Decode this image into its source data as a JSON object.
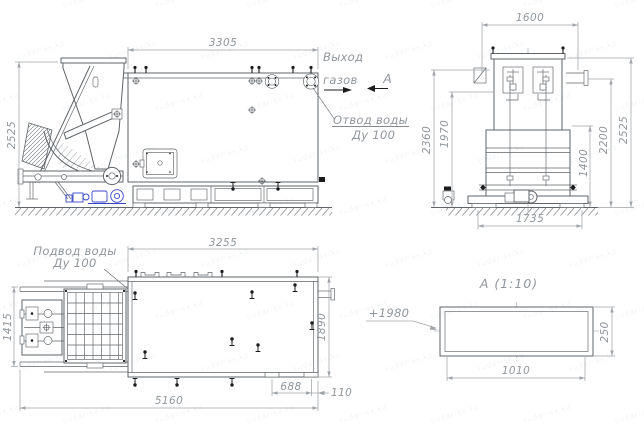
{
  "watermark": {
    "text": "sudar-sv.kz"
  },
  "colors": {
    "line": "#5f6468",
    "dimension": "#a0a4a8",
    "dimension_text": "#90969b",
    "black_fittings": "#1c1c1c",
    "accent_blue": "#3a46c9",
    "watermark": "#6a7a8a",
    "background": "#ffffff"
  },
  "views": {
    "side": {
      "dim_length": "3305",
      "dim_height": "2525",
      "label_gas_1": "Выход",
      "label_gas_2": "газов",
      "label_drain_1": "Отвод воды",
      "label_drain_2": "Ду 100",
      "view_arrow": "А"
    },
    "front": {
      "dim_top": "1600",
      "dim_left_outer": "2360",
      "dim_left_inner": "1970",
      "dim_right_inner": "1400",
      "dim_right_mid": "2200",
      "dim_right_outer": "2525",
      "dim_bottom": "1735"
    },
    "plan": {
      "dim_top": "3255",
      "dim_left": "1415",
      "dim_right": "1890",
      "dim_bottom": "5160",
      "dim_feet": "688",
      "dim_edge": "110",
      "label_supply_1": "Подвод воды",
      "label_supply_2": "Ду 100"
    },
    "detail": {
      "title": "А  (1:10)",
      "dim_width": "1010",
      "dim_height": "250",
      "leader": "+1980"
    }
  }
}
